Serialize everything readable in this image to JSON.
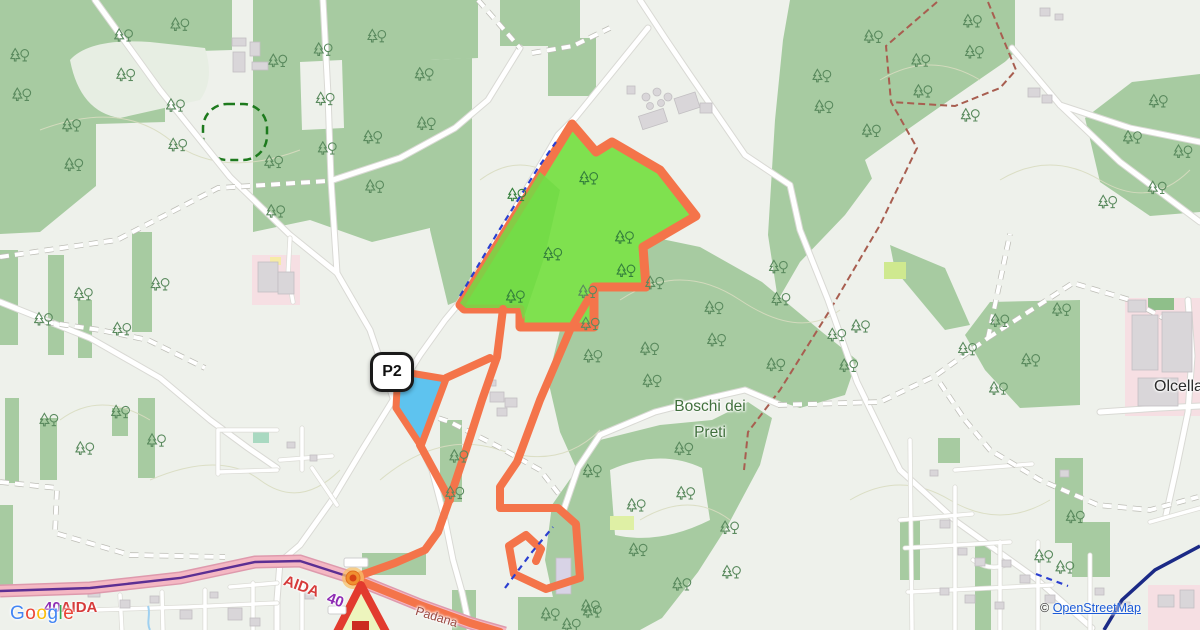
{
  "map": {
    "marker_p2": "P2",
    "labels": {
      "forest_line1": "Boschi dei",
      "forest_line2": "Preti",
      "village": "Olcella",
      "motorway_name_left": "AIDA",
      "motorway_ref_left": "40",
      "motorway_name_right": "AIDA",
      "motorway_ref_right": "40",
      "street": "Padana"
    },
    "colors": {
      "route_orange": "#f4744a",
      "route_area_green": "#7fe14f",
      "water_blue": "#5ec3ef",
      "forest_green": "#a7cba1",
      "motorway_pink": "#f4b7c3",
      "motorway_line_purple": "#5c2f93"
    }
  },
  "attribution": {
    "copyright": "©",
    "link": "OpenStreetMap"
  },
  "logo": {
    "letters": [
      {
        "ch": "G",
        "color": "#4285F4"
      },
      {
        "ch": "o",
        "color": "#EA4335"
      },
      {
        "ch": "o",
        "color": "#FBBC05"
      },
      {
        "ch": "g",
        "color": "#4285F4"
      },
      {
        "ch": "l",
        "color": "#34A853"
      },
      {
        "ch": "e",
        "color": "#EA4335"
      }
    ]
  }
}
